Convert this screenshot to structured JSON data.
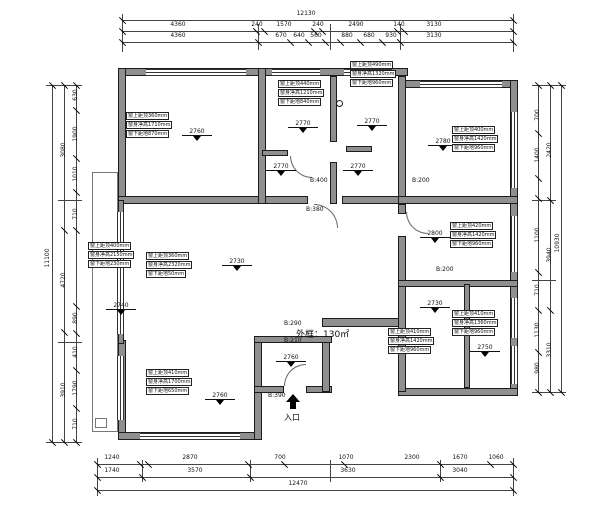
{
  "plan": {
    "area_label": "外框：130㎡",
    "entrance_label": "入口"
  },
  "annotations": [
    {
      "lines": [
        "窗上距顶360mm",
        "窗身净高1710mm",
        "窗下距地870mm"
      ]
    },
    {
      "lines": [
        "窗上距顶440mm",
        "窗身净高1210mm",
        "窗下距地840mm"
      ]
    },
    {
      "lines": [
        "窗上距顶490mm",
        "窗身净高1320mm",
        "窗下距地960mm"
      ]
    },
    {
      "lines": [
        "窗上距顶400mm",
        "窗身净高1420mm",
        "窗下距地960mm"
      ]
    },
    {
      "lines": [
        "窗上距顶420mm",
        "窗身净高1420mm",
        "窗下距地960mm"
      ]
    },
    {
      "lines": [
        "窗上距顶400mm",
        "窗身净高2150mm",
        "窗下距地230mm"
      ]
    },
    {
      "lines": [
        "窗上距顶360mm",
        "窗身净高2320mm",
        "窗下距地50mm"
      ]
    },
    {
      "lines": [
        "窗上距顶410mm",
        "窗身净高1700mm",
        "窗下距地650mm"
      ]
    },
    {
      "lines": [
        "窗上距顶410mm",
        "窗身净高1360mm",
        "窗下距地960mm"
      ]
    },
    {
      "lines": [
        "窗上距顶410mm",
        "窗身净高1420mm",
        "窗下距地960mm"
      ]
    }
  ],
  "elevations": [
    "2760",
    "2770",
    "2770",
    "2780",
    "2770",
    "2770",
    "2800",
    "2730",
    "2740",
    "2760",
    "2730",
    "2750",
    "2760"
  ],
  "beams": [
    "B:400",
    "B:380",
    "B:200",
    "B:200",
    "B:290",
    "B:210",
    "B:390"
  ],
  "dim_top": {
    "total": "12130",
    "row2": [
      "4360",
      "240",
      "1570",
      "240",
      "2490",
      "140",
      "3130"
    ],
    "row3": [
      "4360",
      "670",
      "640",
      "560",
      "880",
      "680",
      "930",
      "3130"
    ]
  },
  "dim_bottom": {
    "total": "12470",
    "row1": [
      "1240",
      "2870",
      "700",
      "1070",
      "2300",
      "1670",
      "1060"
    ],
    "row2": [
      "1740",
      "3570",
      "3630",
      "3040"
    ]
  },
  "dim_left": {
    "total": "11100",
    "mid": [
      "3080",
      "4720",
      "3910"
    ],
    "inner": [
      "630",
      "1900",
      "1010",
      "710",
      "890",
      "410",
      "1790",
      "710"
    ]
  },
  "dim_right": {
    "total": "10930",
    "mid": [
      "2420",
      "3940",
      "3310"
    ],
    "inner": [
      "700",
      "1400",
      "1100",
      "710",
      "1130",
      "980"
    ]
  }
}
